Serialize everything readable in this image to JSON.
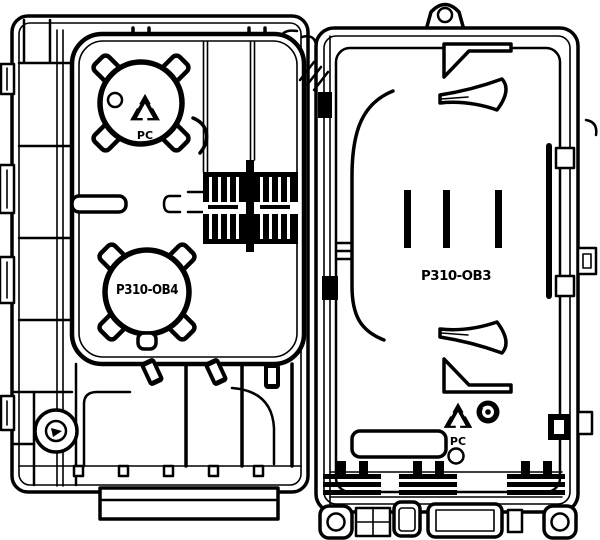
{
  "drawing": {
    "description": "fiber-termination-box-open-line-drawing",
    "left_panel": {
      "bottom_spool_label": "P310-OB4",
      "material_code": "PC"
    },
    "right_panel": {
      "cover_label": "P310-OB3",
      "material_code": "PC"
    },
    "icons": {
      "material_mark": "recycling-icon",
      "fastener": "screw-head-icon",
      "hanger": "mounting-eyelet-icon"
    },
    "colors": {
      "line": "#000000",
      "background": "#ffffff"
    }
  }
}
